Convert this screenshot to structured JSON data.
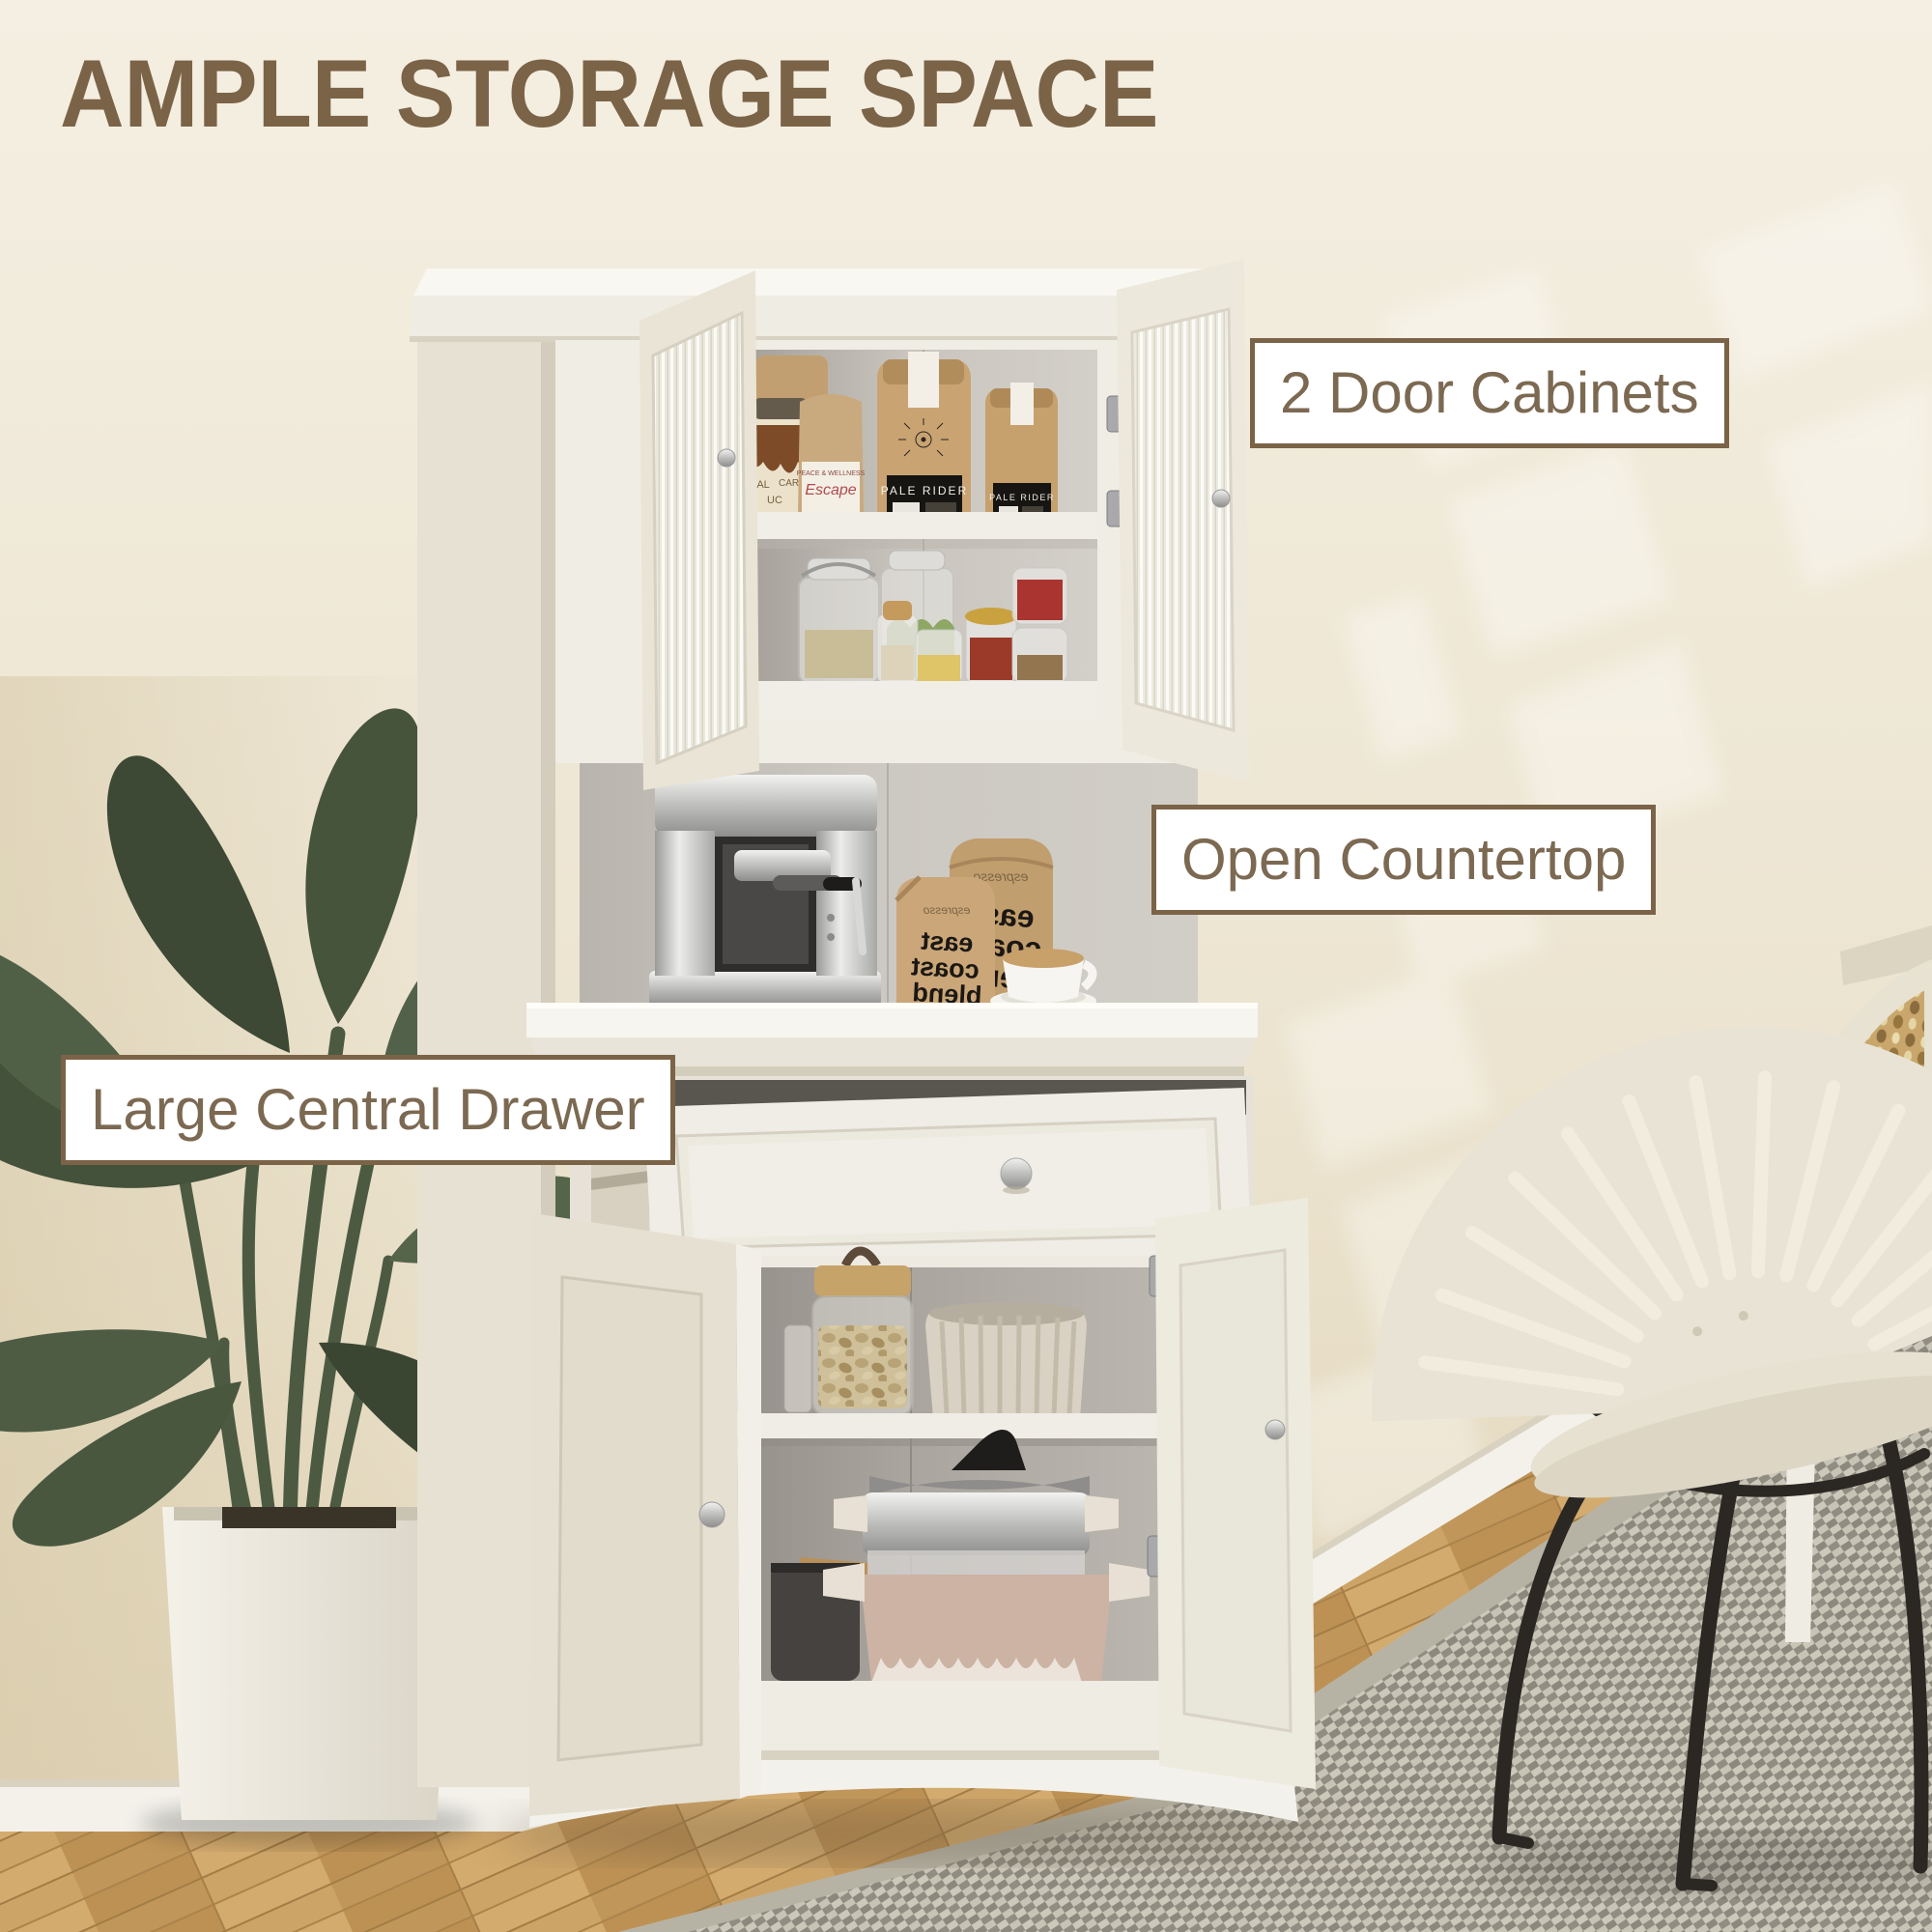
{
  "title": "AMPLE STORAGE SPACE",
  "callouts": {
    "door_cabinets": "2 Door Cabinets",
    "open_countertop": "Open Countertop",
    "central_drawer": "Large Central Drawer"
  },
  "products": {
    "back_bag": "TRAVA",
    "caramel_jar_left": "SAL",
    "caramel_jar_right": "CARAMEL",
    "caramel_jar_bottom": "UC",
    "wellness_line1": "PEACE & WELLNESS",
    "wellness_line2": "Escape",
    "coffee_bag": "PALE RIDER",
    "espresso_script": "espresso",
    "blend_word1": "east",
    "blend_word2": "coast",
    "blend_word3": "blend"
  },
  "colors": {
    "accent_brown": "#7b6347",
    "label_text": "#7c6952",
    "label_bg": "#ffffff",
    "wall": "#efe8d7",
    "wall_dark": "#d9cbab",
    "cabinet_white": "#f1eee6",
    "interior_gray": "#c3bfb8",
    "wood_floor": "#c89f63",
    "rug_gray": "#a5a195",
    "plant_green": "#48553d",
    "kraft": "#c9a472",
    "steel": "#c6c6c4"
  }
}
